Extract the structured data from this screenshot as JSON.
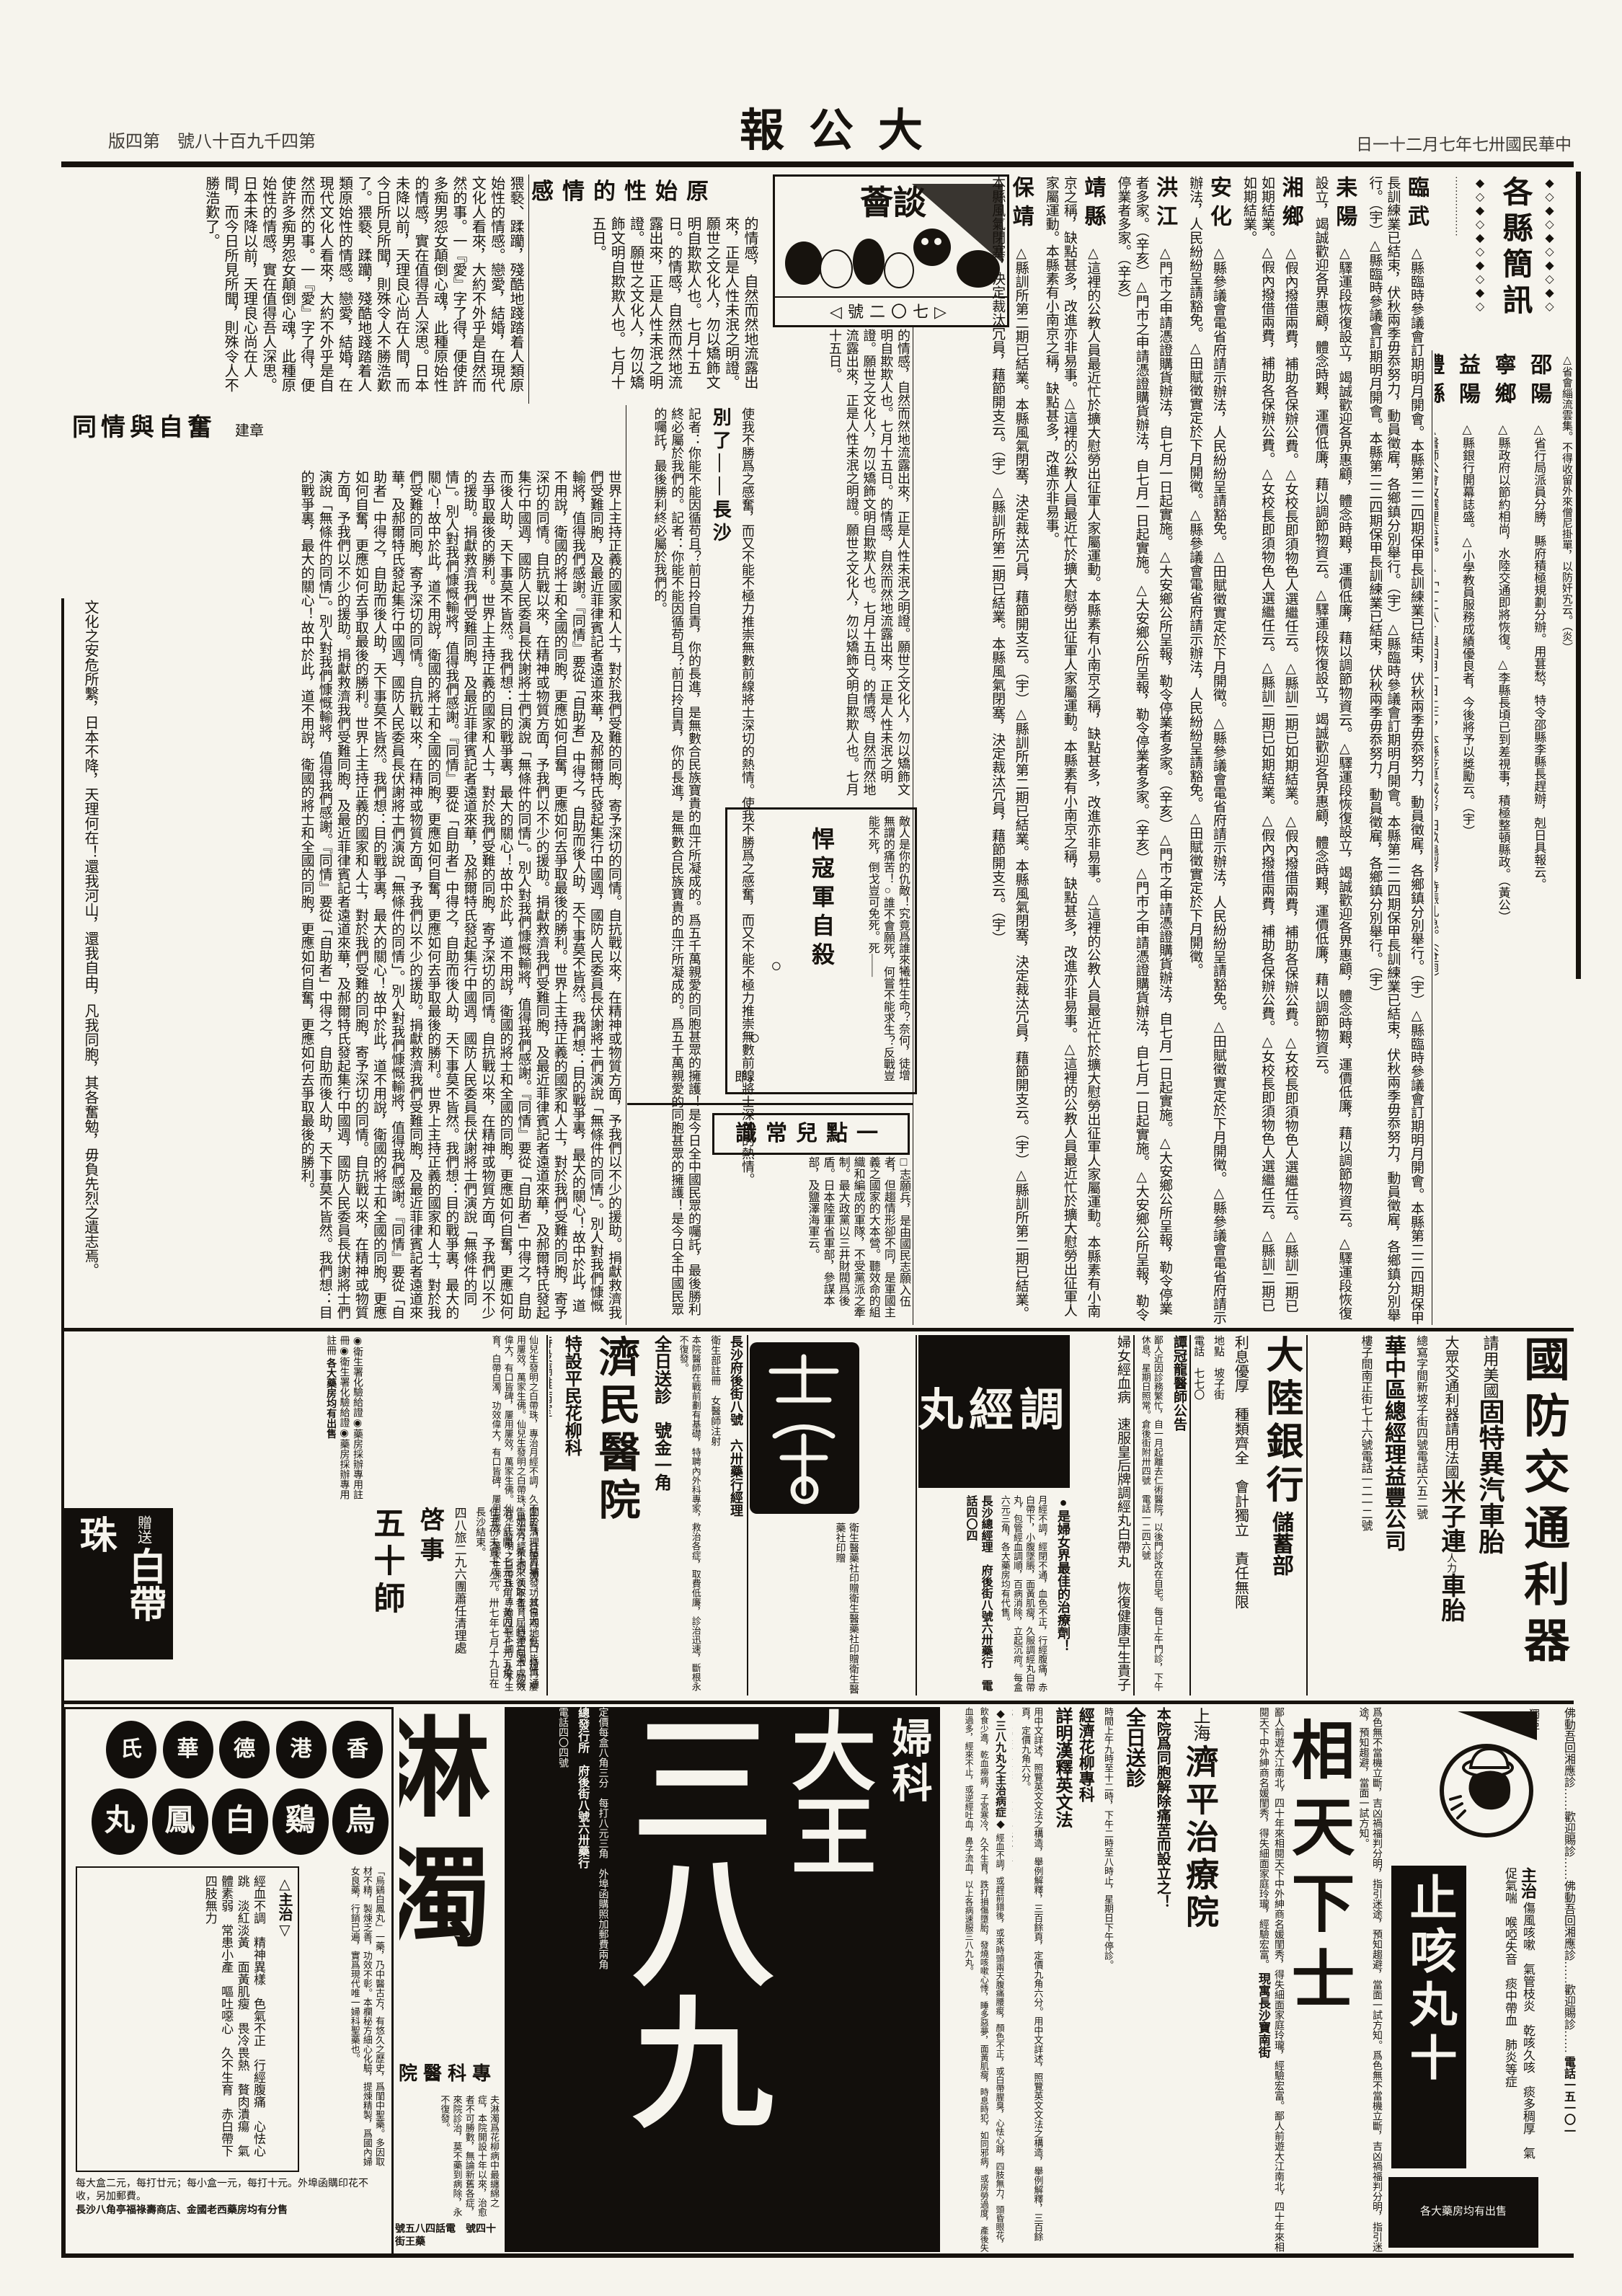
{
  "header": {
    "masthead": "大公報",
    "issue": "第四千九百十八號　第四版",
    "date": "中華民國卅七年七月二十一日"
  },
  "tanhui": {
    "logo_title": "談薈",
    "number": "七〇二號",
    "headline": "原始性的情感"
  },
  "essay": {
    "body": "猥褻、蹂躪，殘酷地踐踏着人類原始性的情感。戀愛，結婚，在現代文化人看來，大約不外乎是自然而然的事。一『愛』字了得，便使許多痴男怨女顛倒心魂，此種原始性的情感，實在值得吾人深思。日本未降以前，天理良心尚在人間，而今日所見所聞，則殊令人不勝浩歎了。",
    "more": "的情感，自然而然地流露出來，正是人性未泯之明證。願世之文化人，勿以矯飾文明自欺欺人也。七月十五日。"
  },
  "tongqing": {
    "title": "同情與自奮",
    "author": "建章",
    "body": "世界上主持正義的國家和人士，對於我們受難的同胞，寄予深切的同情。自抗戰以來，在精神或物質方面，予我們以不少的援助。捐獻救濟我們受難同胞，及最近菲律賓記者遠道來華，及郝爾特氏發起集行中國週，國防人民委員長伏謝將士們演說「無條件的同情」。別人對我們慷慨輸將，值得我們感謝。『同情』要從「自助者」中得之，自助而後人助，天下事莫不皆然。我們想：目的戰爭裏，最大的關心！故中於此，道不用說，衛國的將士和全國的同胞，更應如何自奮，更應如何去爭取最後的勝利。"
  },
  "bieliao": {
    "pre": "使我不勝爲之感奮，而又不能不極力推崇無數前線將士深切的熱情。",
    "title": "別了——長沙",
    "body": "記者：你能不能因循苟且？前日拎自責，你的長進，是無數合民族寶貴的血汗所凝成的。爲五千萬親愛的同胞甚眾的擁護！是今日全中國民眾的囑託，最後勝利終必屬於我們的。"
  },
  "hankou": {
    "title": "悍寇軍自殺",
    "body": "敵人是你的仇敵！究竟爲誰來犧牲生命？奈何，徒增無謂的痛苦！○誰不會願死，何嘗不能求生？反戰豈能不死，倒戈豈可免死。死——",
    "sig": "即。",
    "circle": "○"
  },
  "changshi": {
    "title": "一點兒常識",
    "body": "□志願兵，是由國民志願入伍者，但趨情形卻不同，是軍國主義之國家的大本營。聽效命的組織和編成的軍隊，不受黨派之牽制。最大政黨以三井財閥爲後盾。日本陸軍省軍部，參謀本部，及鹽澤海軍云。"
  },
  "brief": {
    "title": "各縣簡訊",
    "ornament": "◆◇◆◇◆◇◆◇◆◇",
    "dots": "………………",
    "intro": "△省會緇流雲集。不得收留外來僧尼掛單，以防奸宄云。（炎）",
    "a": [
      {
        "name": "邵陽",
        "body": "△省行局派員分勝，縣府積極規劃分辦。用葚愁，特令邵縣李縣長趕辦，剋日具報云。"
      },
      {
        "name": "寧鄉",
        "body": "△縣政府以節約相尚，水陸交通即將恢復。△李縣長頃已到差視事，積極整頓縣政。（黃公）"
      },
      {
        "name": "益陽",
        "body": "△縣銀行開幕誌盛。△小學教員服務成績優良者，今後將予以獎勵云。（宇）"
      },
      {
        "name": "澧縣",
        "body": "△醫師公會改選理監事。△「一二八」與四月一日上午，本縣乾旱成災，田畝龜裂，待賑孔急。（谷雨）"
      }
    ],
    "b": [
      {
        "name": "臨武",
        "body": "△縣臨時參議會訂期明月開會。本縣第二二四期保甲長訓練業已結束，伏秋兩季毋忝努力，動員徵雇，各鄉鎮分別舉行。（宇）"
      },
      {
        "name": "耒陽",
        "body": "△驛運段恢復設立，竭誠歡迎各界惠顧，體念時艱，運價低廉，藉以調節物資云。"
      },
      {
        "name": "湘鄉",
        "body": "△假內撥借兩費，補助各保辦公費。△女校長即須物色人選繼任云。△縣訓二期已如期結業。"
      },
      {
        "name": "安化",
        "body": "△縣參議會電省府請示辦法，人民紛紛呈請豁免。△田賦徵實定於下月開徵。"
      },
      {
        "name": "洪江",
        "body": "△門市之申請憑證購貨辦法，自七月一日起實施。△大安鄉公所呈報，勒令停業者多家。（辛亥）"
      },
      {
        "name": "靖縣",
        "body": "△這裡的公教人員最近忙於擴大慰勞出征軍人家屬運動。本縣素有小南京之稱，缺點甚多，改進亦非易事。"
      },
      {
        "name": "保靖",
        "body": "△縣訓所第二期已結業。本縣風氣閉塞，決定裁汰冗員，藉節開支云。（宇）"
      }
    ]
  },
  "leftedge": {
    "text": "文化之安危所繫，日本不降，天理何在！還我河山，還我自由，凡我同胞，其各奮勉，毋負先烈之遺志焉。"
  },
  "ads": {
    "goodyear": {
      "title": "國防交通利器",
      "line1_small": "請用美國",
      "line1_big": "固特異汽車胎",
      "line2_small": "大眾交通利器請用法國",
      "line2_big": "米子連",
      "line2_note": "人力",
      "line2_tail": "車胎",
      "office1": "總寫字間新坡子街四號電話六五二號",
      "company": "華中區總經理益豐公司",
      "office2": "樓子間南正街七十六號電話一二一二號"
    },
    "bank": {
      "name": "大陸銀行",
      "dept": "儲蓄部",
      "features": [
        "利息優厚",
        "種類齊全",
        "會計獨立",
        "責任無限"
      ],
      "addr": "地點　坡子街",
      "tel": "電話　七七〇"
    },
    "tan": {
      "title": "譚冠龍醫師公告",
      "body": "鄙人近因診務繁忙，自一月起離去仁術醫院，以後門診改在自宅。每日上午門診，下午休息，星期日照常。倉後街附卅四號　電話一二四六號"
    },
    "tiaojing": {
      "headline": "婦女經血病　速服皇后牌調經丸白帶丸　恢復健康早生貴子",
      "logo": "調經丸",
      "slogan": "●是婦女界最佳的治療劑！",
      "body": "月經不調，經閉不通，血色不正，行經腹痛，赤白帶下，小腹墜脹，面黃肌瘦，久服調經丸白帶丸，包管經血調順，百病消除，立起沉疴。每盒六元三角，各大藥房均有代售。",
      "agent": "長沙總經理　府後街八號六卅藥行　電話四〇四"
    },
    "shelogo": {
      "caption": "衛生醫藥社印贈"
    },
    "jimin": {
      "mover": "由屈遷租",
      "name": "濟民醫院",
      "fee": "全日送診　號金一角",
      "dept1": "特設平民花柳科",
      "dept2": "特設隔離病室",
      "note": "衛生部註冊　女醫師注射",
      "body": "本院醫師在戰前劃有基礎，特聘內外科專家，救治各症，取費低廉，診治迅速，斷根永不復發。",
      "agent": "長沙府後街八號　六卅藥行經理"
    },
    "baidai": {
      "brand_small": "贈送",
      "brand_big": "白帶珠",
      "cert": "◉衛生署化驗給證◉藥房採辦專用註冊",
      "body": "仙兒生發明之白帶珠，專治月經不調，久不生育，白帶白濁，功效偉大，有口皆碑，屢用屢效，萬家生佛。",
      "sale": "各大藥房均有出售"
    },
    "wushi": {
      "unit_big": "五十師",
      "unit_small": "四八旅二九六團蕭任清理處",
      "title": "啓事",
      "body": "關於清理結算補發，其日期地點，特再通告如次：希未來領取者，屆時逕向本處接洽。計開：七元五角，黃四十七元五角，住五份夫貲十八元。卅七年七月十九日在長沙結束。"
    },
    "cough": {
      "corner": "獨亞",
      "zhuzhi_label": "主治",
      "symptoms": [
        "傷風咳嗽",
        "氣管枝炎",
        "乾咳久咳",
        "痰多稠厚",
        "氣促氣喘",
        "喉啞失音",
        "痰中帶血",
        "肺炎等症"
      ],
      "big_white": "止咳丸十",
      "footer": "各大藥房均有出售",
      "side_col": "佛動吾回湘應診……歡迎賜診……",
      "side_tel": "電話一五一〇一"
    },
    "xiang": {
      "title": "相天下士",
      "right_col": "爲色無不當機立斷，吉凶禍福判分明，指引迷途，預知趨避，當面一試方知。",
      "left_col": "鄙人前遊大江南北，四十年來相閱天下中外紳商名媛閨秀，得失細面家庭玲瓏，經驗宏富。",
      "addr": "現寓長沙寶南街"
    },
    "jiping": {
      "city": "上海",
      "name": "濟平治療院",
      "slogan": "本院爲同胞解除痛苦而設立之！",
      "fee": "全日送診",
      "hours": "時間上午九時至十二時，下午二時至八時止，星期日下午停診。",
      "dept": "經濟花柳專科",
      "doctor": "主任醫師　包濟生",
      "services": "下疳　割包皮　白濁急性者用頓挫療法數日痊愈",
      "note": "動手術特別從廉僅收十元，免開刀之苦。"
    },
    "book": {
      "title": "詳明漢釋英文法",
      "body": "用中文詳述，照覽英文文法之構造，舉例解釋，三百餘頁，定價九角六分。",
      "seller": "代售處長沙各大書局　東萬興紙號印行"
    },
    "f389": {
      "label": "婦科",
      "dawang": "大王",
      "giant": "三八九",
      "zhuzhi_head": "◆三八九丸之主治病症◆",
      "zhuzhi_body": "經血不調，或趕前錯後，或來時頭兩天腹痛腰痠，顏色不正，或白帶腥臭，心怯心跳，四肢無力，頭昏眼花，飲食少進，乾血癆病，子宮寒冷，久不生育，跌打損傷墮胎，發燒咳嗽心悸，睡多惡夢，面黃肌瘦，時息時犯，如同邪病，或房勞過度，產後失血過多，經來不止，或逆經吐血，鼻子流血，以上各病速服三八九丸。",
      "price": "定價每盒八角三分　每打八元三角　外埠函購照加郵費兩角",
      "agent": "總發行所　府後街八號六卅藥行",
      "tel": "電話四〇四號"
    },
    "linzhuo": {
      "title": "淋濁",
      "subtitle": "專科醫院",
      "body": "夫淋濁爲花柳病中最纏綿之症，本院開設十年以來，治愈者不可勝數，無論新舊各症，來院診治，莫不藥到病除，永不復發。",
      "addr": "藥王街十四號　電話四八五號"
    },
    "baifeng": {
      "row1": "香港德華氏",
      "row2": "烏鷄白鳳丸",
      "desc": "「烏鷄白鳳丸」一藥，乃中醫古方，有悠久之歷史，爲閨中聖藥。多因取材不精，製煉乏善，功效不彰。本欄秘方細心化驗，提煉精製，爲國內婦女良藥，行銷已遍，實爲現代唯一婦科聖藥也。",
      "zhuzhi_label": "△主治▽",
      "symptoms": [
        "經血不調",
        "精神異樣",
        "色氣不正",
        "行經腹痛",
        "心怯心跳",
        "淡紅淡黃",
        "面黃肌瘦",
        "畏冷畏熱",
        "贅肉潰瘍",
        "氣體素弱",
        "常患小產",
        "嘔吐噁心",
        "久不生育",
        "赤白帶下",
        "四肢無力"
      ],
      "price": "每大盒二元，每打廿元；每小盒一元，每打十元。外埠函購印花不收，另加郵費。",
      "sellers": "長沙八角亭福祿壽商店、金國老西藥房均有分售"
    }
  }
}
